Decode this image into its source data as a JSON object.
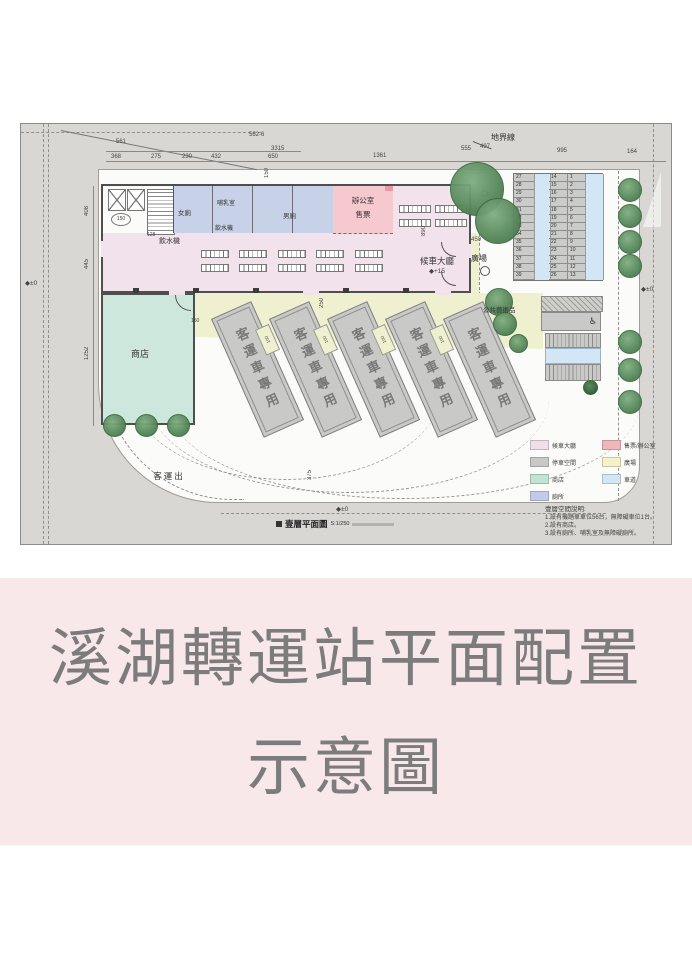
{
  "banner": {
    "line1": "溪湖轉運站平面配置",
    "line2": "示意圖"
  },
  "plan": {
    "boundary_label": "地界線",
    "labels": {
      "women_toilet": "女廁",
      "nursing_room": "哺乳室",
      "men_toilet": "男廁",
      "water_dispenser": "飲水機",
      "office_l1": "辦公室",
      "office_l2": "售票",
      "waiting_hall": "候車大廳",
      "waiting_hall_level": "◆+15",
      "entrance_plaza": "入口廣場",
      "greening": "綠美化",
      "shop": "商店",
      "public_art": "公共藝術品",
      "bus_exit": "客運出",
      "bus_bay": "客運車專用",
      "level_zero": "◆±0"
    },
    "dims": {
      "parcel_a": "561",
      "parcel_b": "562-6",
      "total": "3315",
      "w1": "368",
      "w2": "275",
      "w3": "230",
      "w4": "432",
      "w5": "650",
      "w6": "1361",
      "w7": "555",
      "w8": "497",
      "w9": "995",
      "w10": "164",
      "h1": "408",
      "h2": "445",
      "h3": "1252",
      "s150": "150",
      "s150b": "150",
      "s150c": "150",
      "s120": "120",
      "s128": "128",
      "s250": "250",
      "s250b": "250",
      "s890": "890",
      "s450": "450",
      "s100": "100",
      "s375": "375"
    },
    "parking": {
      "left": [
        27,
        28,
        29,
        30,
        31,
        32,
        33,
        34,
        35,
        36,
        37,
        38,
        39
      ],
      "mid": [
        14,
        15,
        16,
        17,
        18,
        19,
        20,
        21,
        22,
        23,
        24,
        25,
        26
      ],
      "right": [
        1,
        2,
        3,
        4,
        5,
        6,
        7,
        8,
        9,
        10,
        11,
        12,
        13
      ]
    },
    "legend": {
      "items": [
        {
          "label": "候車大廳",
          "color": "#f0dfe9"
        },
        {
          "label": "售票/辦公室",
          "color": "#efb6bb"
        },
        {
          "label": "停車空間",
          "color": "#c8c8c6"
        },
        {
          "label": "廣場",
          "color": "#f6f2c8"
        },
        {
          "label": "商店",
          "color": "#c2e2d2"
        },
        {
          "label": "車道",
          "color": "#d3e6f5"
        },
        {
          "label": "廁所",
          "color": "#c4cbe6"
        }
      ]
    },
    "notes": {
      "heading": "壹層空間說明:",
      "lines": [
        "1.設有機踏車車位56台，無障礙車位1台。",
        "2.設有商店。",
        "3.設有廁所、哺乳室及無障礙廁所。"
      ]
    },
    "titleblock": {
      "name": "壹層平面圖",
      "scale": "S:1/250"
    }
  }
}
